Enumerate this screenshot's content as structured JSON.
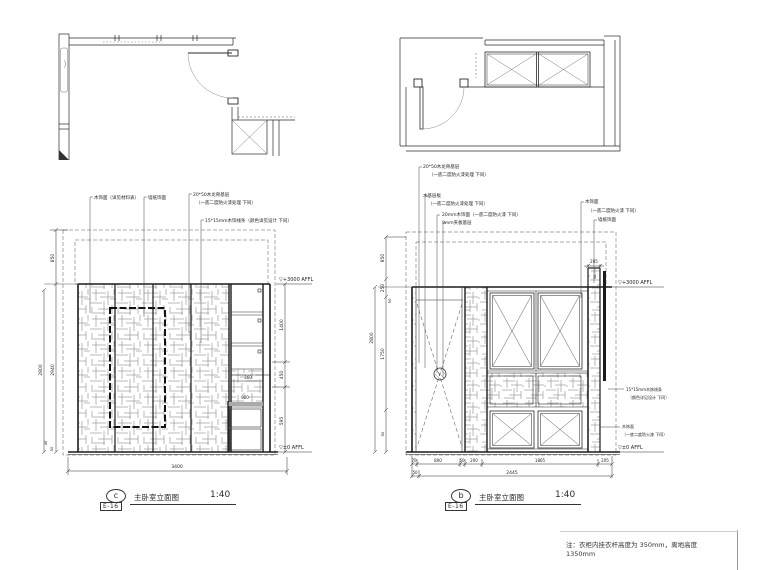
{
  "colors": {
    "background": "#ffffff",
    "line": "#2a2a2a",
    "texture": "#8a8a8a",
    "dashed": "#555555"
  },
  "elev_c": {
    "ann": [
      "木饰面（详见材料表）",
      "墙纸饰面",
      "20*50木龙骨基层",
      "（一底二度防火漆处理 下同）",
      "15*15mm木饰线条（颜色详见设计 下同）"
    ],
    "marker_top": "▽+3000  AFFL",
    "marker_bottom": "▽±0  AFFL",
    "dims": {
      "h850": "850",
      "h2800": "2800",
      "h2940": "2940",
      "h40": "40",
      "h50": "50",
      "r1400": "1400",
      "r450": "450",
      "r595": "595",
      "s360": "360",
      "s900": "900",
      "w3400": "3400"
    },
    "tag": {
      "letter": "c",
      "sheet": "E-16",
      "title": "主卧室立面图",
      "scale": "1:40"
    }
  },
  "elev_b": {
    "ann_left": [
      "20*50木龙骨基层",
      "（一底二度防火漆处理 下同）",
      "木基层板",
      "（一底二度防火漆处理 下同）",
      "20mm木饰面（一底二度防火漆 下同）",
      "9mm夹板基层"
    ],
    "ann_right": [
      "木饰面",
      "（一底二度防火漆 下同）",
      "墙纸饰面"
    ],
    "ann_mid": [
      "15*15mm木饰线条",
      "（颜色详见设计 下同）",
      "木饰面",
      "（一底二度防火漆 下同）"
    ],
    "marker_top": "▽+3000  AFFL",
    "marker_bottom": "▽±0  AFFL",
    "dims": {
      "h850": "850",
      "h250": "250",
      "h50a": "50",
      "h1750": "1750",
      "h2800": "2800",
      "h50b": "50",
      "t205": "205",
      "i50": "50",
      "b70": "70",
      "b800": "800",
      "b50": "50",
      "b200": "200",
      "b1865": "1865",
      "b205": "205",
      "r2_50": "50",
      "total": "2445"
    },
    "tag": {
      "letter": "b",
      "sheet": "E-16",
      "title": "主卧室立面图",
      "scale": "1:40"
    }
  },
  "note": {
    "line1": "注：衣柜内挂衣杆高度为 350mm，离地高度",
    "line2": "1350mm"
  }
}
